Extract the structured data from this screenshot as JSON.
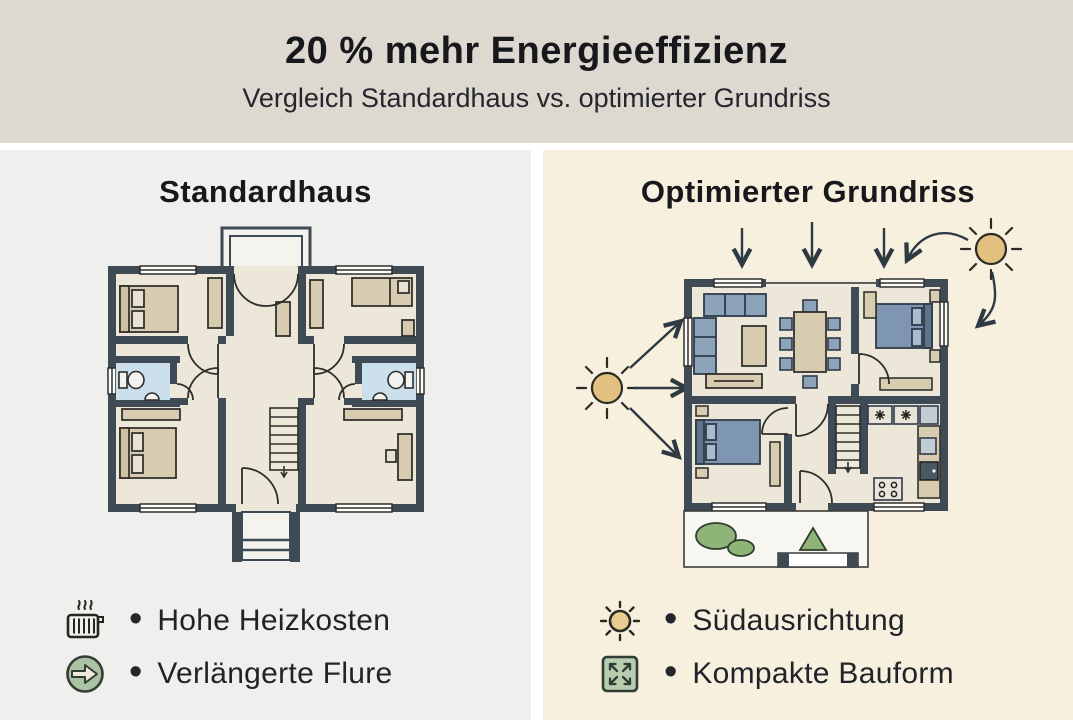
{
  "header": {
    "title": "20 % mehr Energieeffizienz",
    "subtitle": "Vergleich Standardhaus vs. optimierter Grundriss"
  },
  "left_panel": {
    "title": "Standardhaus",
    "bullets": [
      {
        "icon": "radiator-icon",
        "label": "Hohe Heizkosten"
      },
      {
        "icon": "arrow-right-circle-icon",
        "label": "Verlängerte Flure"
      }
    ]
  },
  "right_panel": {
    "title": "Optimierter Grundriss",
    "bullets": [
      {
        "icon": "sun-icon",
        "label": "Südausrichtung"
      },
      {
        "icon": "expand-arrows-icon",
        "label": "Kompakte Bauform"
      }
    ]
  },
  "colors": {
    "header_bg": "#ded9d0",
    "left_panel_bg": "#efefed",
    "right_panel_bg": "#f7f0df",
    "wall": "#3e4a54",
    "floor": "#ece7d9",
    "furniture_tan": "#d8ccb0",
    "furniture_blue": "#8398b0",
    "bathroom_blue": "#cbdfec",
    "green": "#8fb478",
    "sun": "#e2c080",
    "text": "#1d2025"
  }
}
